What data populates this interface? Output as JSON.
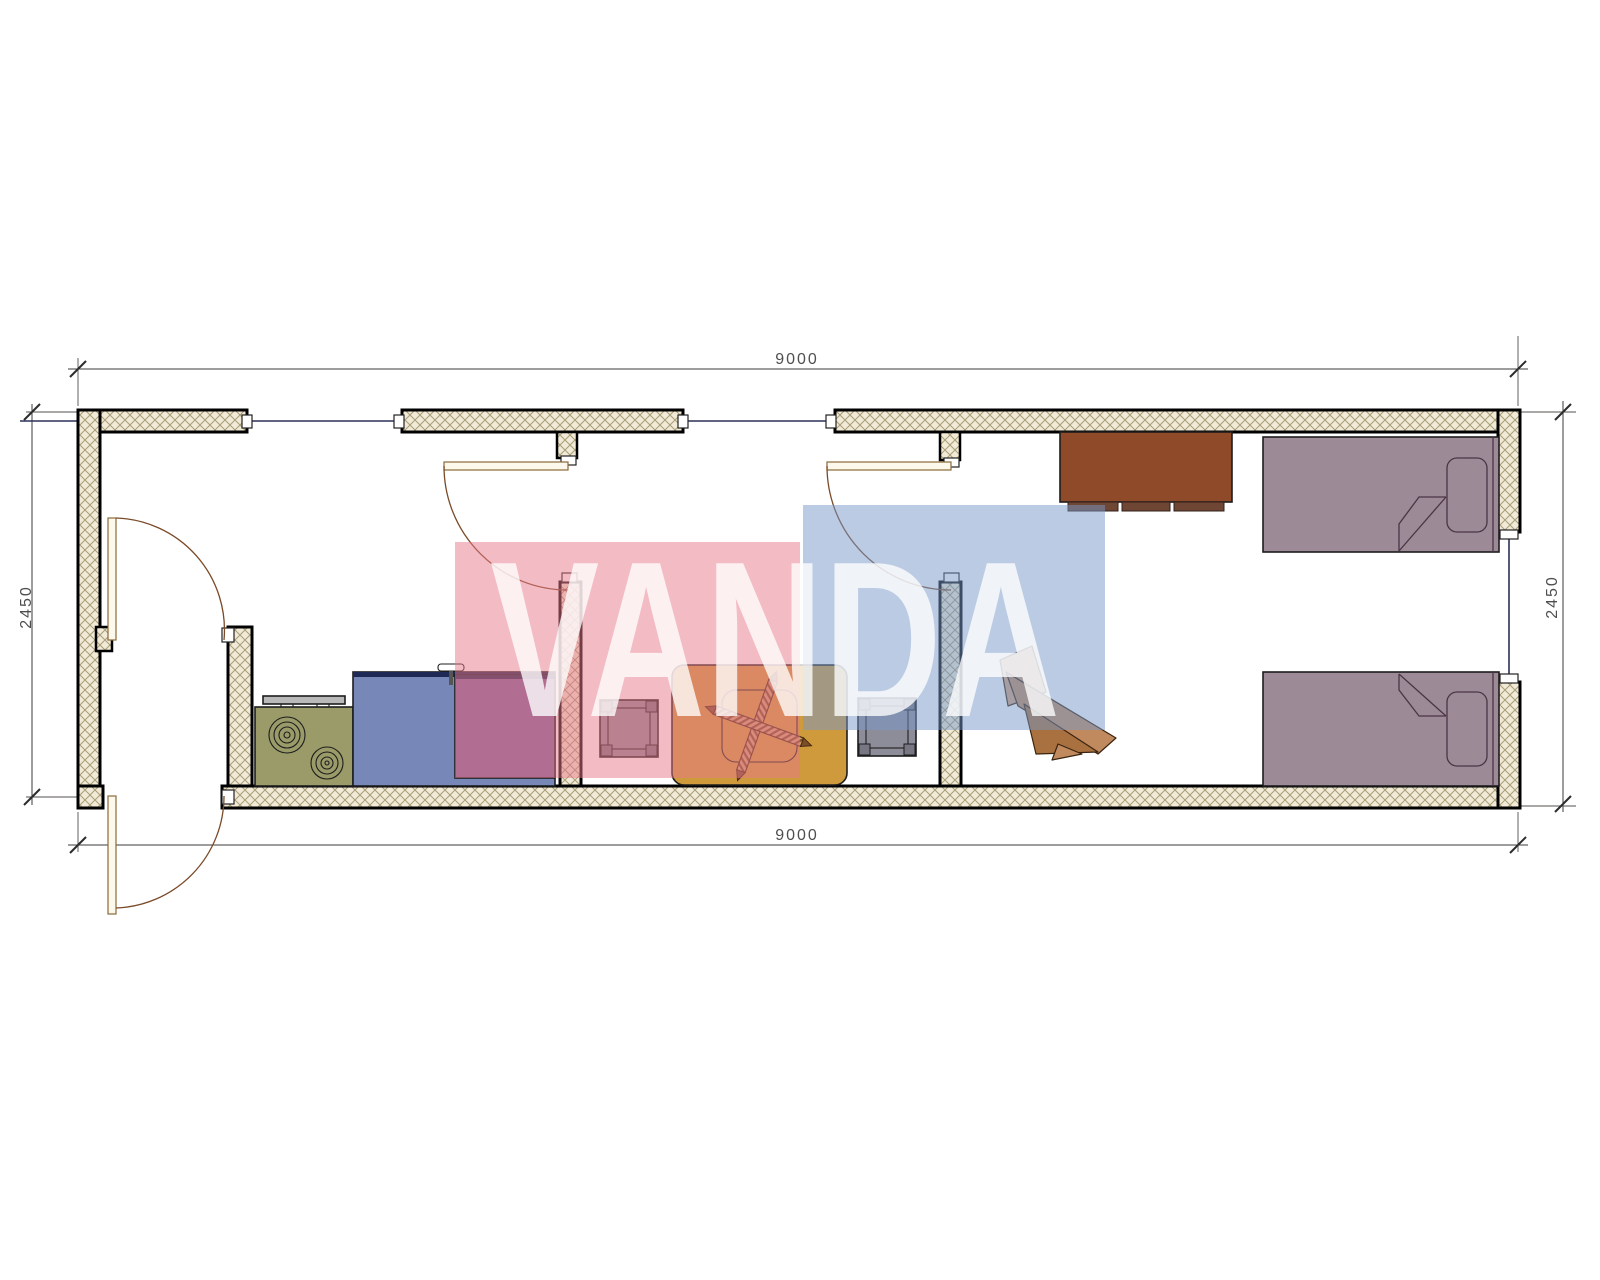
{
  "drawing": {
    "type": "floor-plan",
    "description": "Single-storey modular container unit plan with vestibule, kitchen, dining room and bedroom with two beds",
    "watermark": {
      "text": "VANDA",
      "red_block": "#e87888",
      "blue_block": "#7898c8",
      "text_color": "#ffffff"
    },
    "dimensions": {
      "top": "9000",
      "bottom": "9000",
      "left": "2450",
      "right": "2450"
    },
    "colors": {
      "wall_hatch_bg": "#f1ead7",
      "wall_hatch_line": "#a89c78",
      "wall_outline": "#000000",
      "window_line": "#2c3158",
      "dimension": "#3b3b3b",
      "door_swing": "#7a4a28",
      "stove": "#9a9b69",
      "counter": "#7787b7",
      "counter_edge": "#1e2a55",
      "cabinet": "#7a639c",
      "vent": "#b9b9b9",
      "faucet": "#8f8f8f",
      "table": "#cf9a3c",
      "stool": "#8d8d99",
      "wardrobe": "#8e4a29",
      "wardrobe_base": "#6f4533",
      "chair_light": "#d4a57c",
      "chair_mid": "#c08a5e",
      "chair_dark": "#a9713f",
      "bed": "#9c8a97"
    },
    "furniture": [
      {
        "name": "stove",
        "room": "kitchen"
      },
      {
        "name": "sink-counter",
        "room": "kitchen"
      },
      {
        "name": "cabinet",
        "room": "kitchen"
      },
      {
        "name": "dining-table",
        "room": "dining"
      },
      {
        "name": "stool",
        "room": "dining",
        "count": 2
      },
      {
        "name": "wardrobe",
        "room": "bedroom"
      },
      {
        "name": "desk-chair",
        "room": "bedroom"
      },
      {
        "name": "single-bed",
        "room": "bedroom",
        "count": 2
      }
    ]
  }
}
